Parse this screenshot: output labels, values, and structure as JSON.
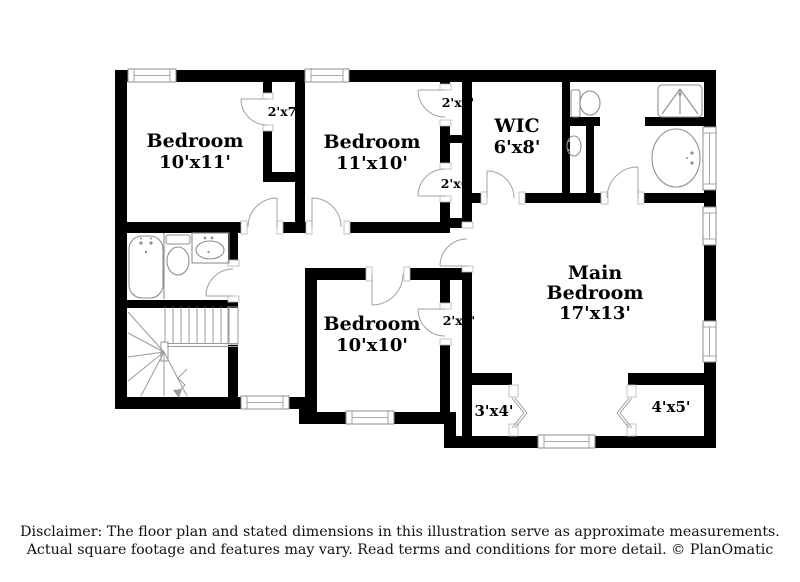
{
  "plan": {
    "rooms": [
      {
        "name": "Bedroom",
        "dims": "10'x11'"
      },
      {
        "name": "Bedroom",
        "dims": "11'x10'"
      },
      {
        "name": "WIC",
        "dims": "6'x8'"
      },
      {
        "name": "Main",
        "name_line2": "Bedroom",
        "dims": "17'x13'"
      },
      {
        "name": "Bedroom",
        "dims": "10'x10'"
      }
    ],
    "closets": [
      {
        "label": "2'x7'"
      },
      {
        "label": "2'x4'"
      },
      {
        "label": "2'x6'"
      },
      {
        "label": "2'x8'"
      },
      {
        "label": "3'x4'"
      },
      {
        "label": "4'x5'"
      }
    ],
    "fixtures": [
      "bathtub",
      "toilet",
      "sink",
      "shower-stall",
      "staircase",
      "down-arrow"
    ],
    "window_count": 8,
    "colors": {
      "wall": "#000000",
      "fixture": "#8f8f8f",
      "door": "#a0a0a0",
      "text": "#000000",
      "bg": "#ffffff"
    }
  },
  "disclaimer": {
    "line1": "Disclaimer: The floor plan and stated dimensions in this illustration serve as approximate measurements.",
    "line2": "Actual square footage and features may vary. Read terms and conditions for more detail. © PlanOmatic"
  }
}
